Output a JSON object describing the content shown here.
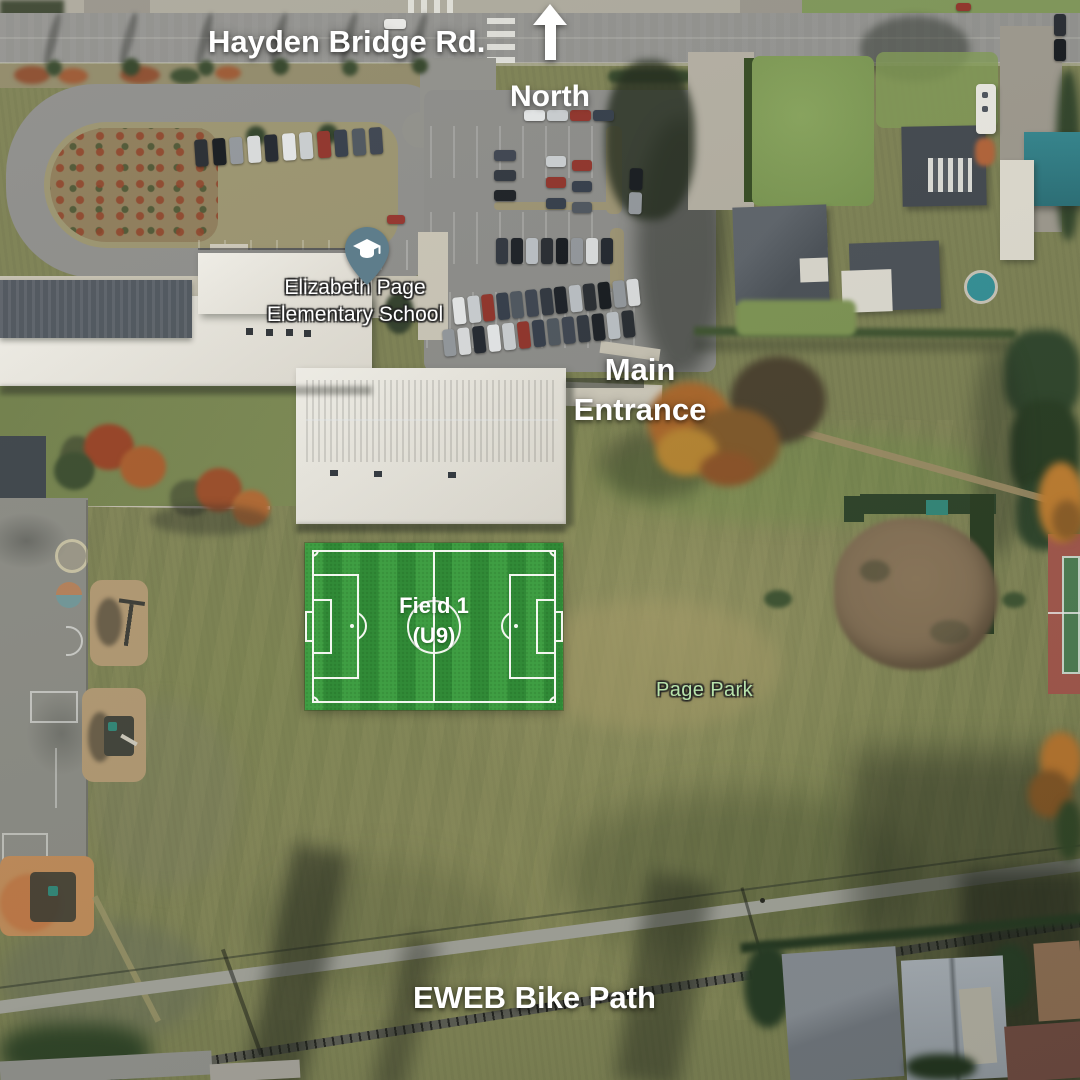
{
  "annotations": {
    "road_label": "Hayden Bridge Rd.",
    "north_label": "North",
    "main_entrance_line1": "Main",
    "main_entrance_line2": "Entrance",
    "bike_path_label": "EWEB Bike Path"
  },
  "map_labels": {
    "school_line1": "Elizabeth Page",
    "school_line2": "Elementary School",
    "park": "Page Park"
  },
  "field_overlay": {
    "name": "Field 1",
    "division": "(U9)"
  },
  "icons": {
    "north_arrow": "up-arrow",
    "school_pin": "school-graduation-cap-pin"
  },
  "colors": {
    "annotation_text": "#ffffff",
    "park_label_text": "#b7e2ab",
    "school_pin_fill": "#5e7d8b",
    "field_stripe_light": "#3f9e43",
    "field_stripe_dark": "#318a37",
    "field_line": "#f3f7f0"
  }
}
